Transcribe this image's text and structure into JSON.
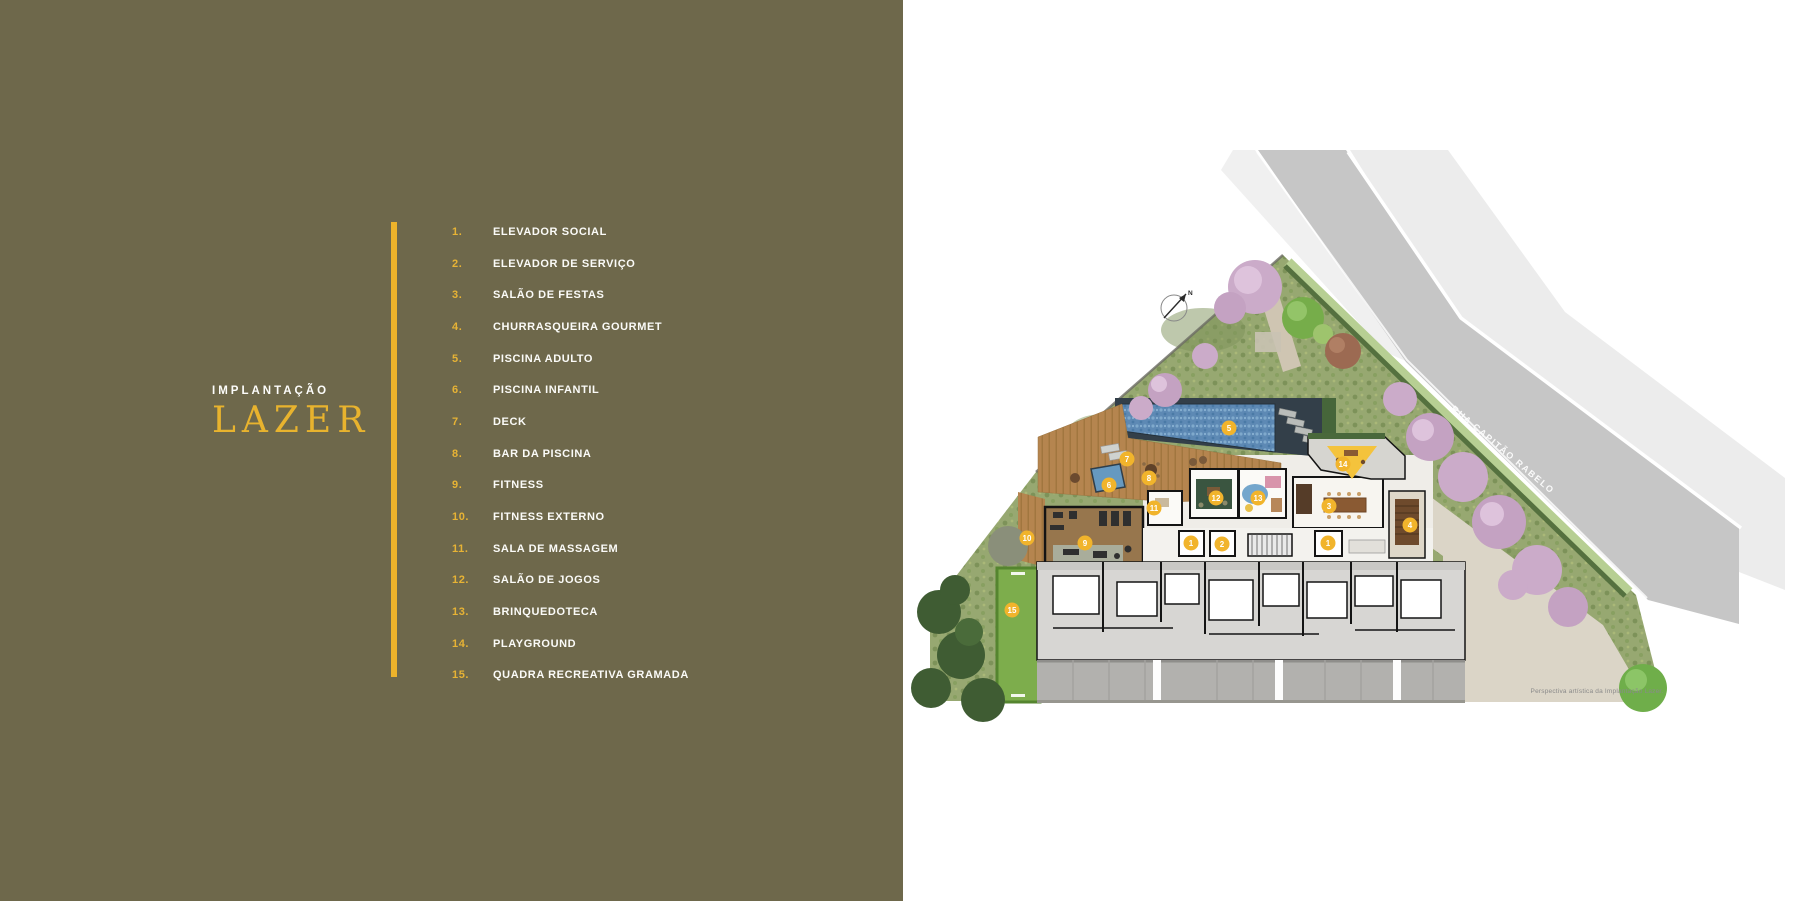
{
  "left_panel": {
    "section_label": "IMPLANTAÇÃO",
    "title": "LAZER",
    "legend": [
      {
        "num": "1.",
        "label": "ELEVADOR SOCIAL"
      },
      {
        "num": "2.",
        "label": "ELEVADOR DE SERVIÇO"
      },
      {
        "num": "3.",
        "label": "SALÃO DE FESTAS"
      },
      {
        "num": "4.",
        "label": "CHURRASQUEIRA GOURMET"
      },
      {
        "num": "5.",
        "label": "PISCINA ADULTO"
      },
      {
        "num": "6.",
        "label": "PISCINA INFANTIL"
      },
      {
        "num": "7.",
        "label": "DECK"
      },
      {
        "num": "8.",
        "label": "BAR DA PISCINA"
      },
      {
        "num": "9.",
        "label": "FITNESS"
      },
      {
        "num": "10.",
        "label": "FITNESS EXTERNO"
      },
      {
        "num": "11.",
        "label": "SALA DE MASSAGEM"
      },
      {
        "num": "12.",
        "label": "SALÃO DE JOGOS"
      },
      {
        "num": "13.",
        "label": "BRINQUEDOTECA"
      },
      {
        "num": "14.",
        "label": "PLAYGROUND"
      },
      {
        "num": "15.",
        "label": "QUADRA RECREATIVA GRAMADA"
      }
    ]
  },
  "logo": {
    "brand": "SERENO",
    "tagline": "JD. SÃO PAULO"
  },
  "plan": {
    "street_label": "RUA CAPITÃO RABELO",
    "caption": "Perspectiva artística da Implantação Lazer.",
    "north_label": "N",
    "markers": [
      {
        "n": "1",
        "x": 288,
        "y": 543
      },
      {
        "n": "2",
        "x": 319,
        "y": 544
      },
      {
        "n": "1",
        "x": 425,
        "y": 543
      },
      {
        "n": "3",
        "x": 426,
        "y": 506
      },
      {
        "n": "4",
        "x": 507,
        "y": 525
      },
      {
        "n": "5",
        "x": 326,
        "y": 428
      },
      {
        "n": "6",
        "x": 206,
        "y": 485
      },
      {
        "n": "7",
        "x": 224,
        "y": 459
      },
      {
        "n": "8",
        "x": 246,
        "y": 478
      },
      {
        "n": "9",
        "x": 182,
        "y": 543
      },
      {
        "n": "10",
        "x": 124,
        "y": 538
      },
      {
        "n": "11",
        "x": 251,
        "y": 508
      },
      {
        "n": "12",
        "x": 313,
        "y": 498
      },
      {
        "n": "13",
        "x": 355,
        "y": 498
      },
      {
        "n": "14",
        "x": 440,
        "y": 464
      },
      {
        "n": "15",
        "x": 109,
        "y": 610
      }
    ]
  },
  "disclaimer": {
    "line1": "A VEGETAÇÃO QUE COMPÕE O PAISAGISMO RETRATADO NAS PERSPECTIVAS É MERAMENTE ILUSTRATIVA E APRESENTA PORTE ADULTO DE REFERÊNCIA. NA ENTREGA DO EMPREENDIMENTO, ESTA VEGETAÇÃO PODERÁ APRESENTAR",
    "line2": "DIFERENÇAS DE TAMANHO DE PORTE, MAS ESTARÁ DE ACORDO COM O PROJETO PAISAGÍSTICO. A VISTA APRESENTADA NAS IMAGENS É MERAMENTE ILUSTRATIVA, NÃO SENDO A FOTOGRAFIA EXATA DO LOCAL."
  },
  "colors": {
    "panel_olive": "#6e684b",
    "accent_gold": "#edb32b",
    "marker_gold": "#f1b42c",
    "brand_olive": "#6b6452",
    "pool_blue": "#5d89b4",
    "lawn_green": "#7dad4c",
    "road_gray": "#c6c6c6"
  }
}
